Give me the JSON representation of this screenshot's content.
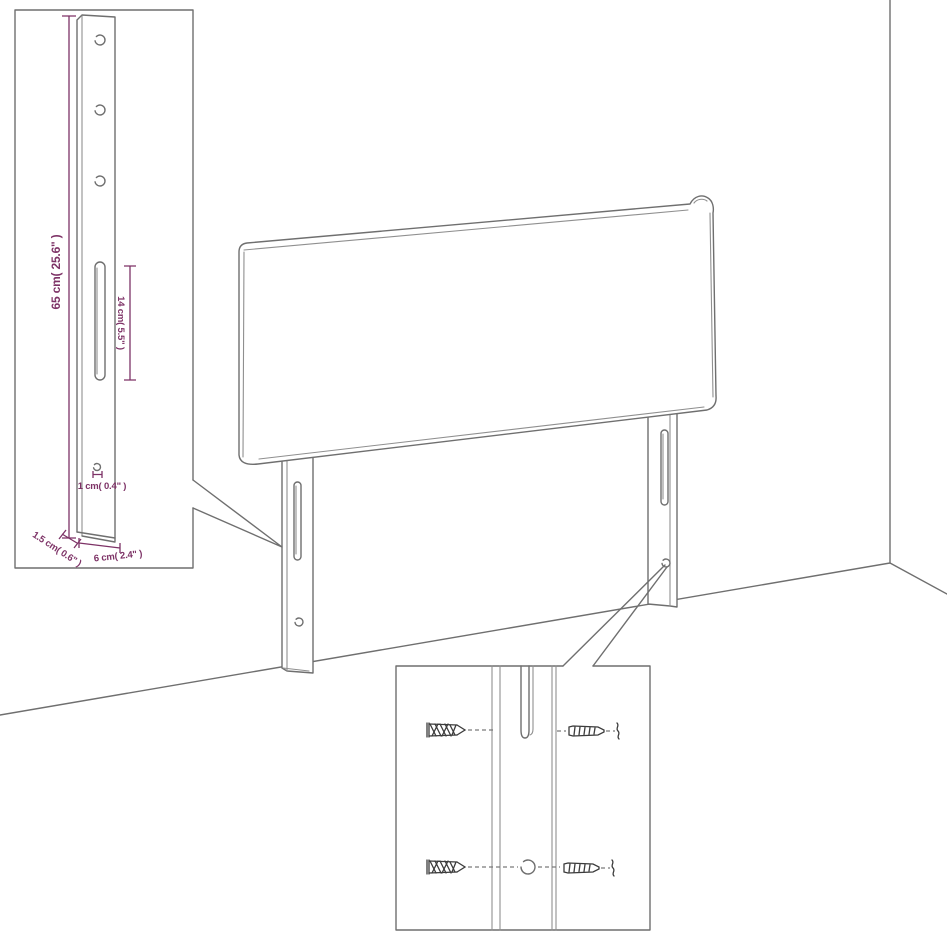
{
  "diagram": {
    "subject": "headboard-with-legs-dimension-diagram",
    "dimension_labels": {
      "leg_height": "65 cm( 25.6\" )",
      "slot_length": "14 cm( 5.5\" )",
      "hole_diameter": "1 cm( 0.4\" )",
      "leg_thickness": "1.5 cm( 0.6\" )",
      "leg_width": "6 cm( 2.4\" )"
    },
    "colors": {
      "dimension_accent": "#7d3266",
      "line_art": "#6f6f6f",
      "hardware_dark": "#3c3c3c",
      "background": "#ffffff"
    }
  }
}
